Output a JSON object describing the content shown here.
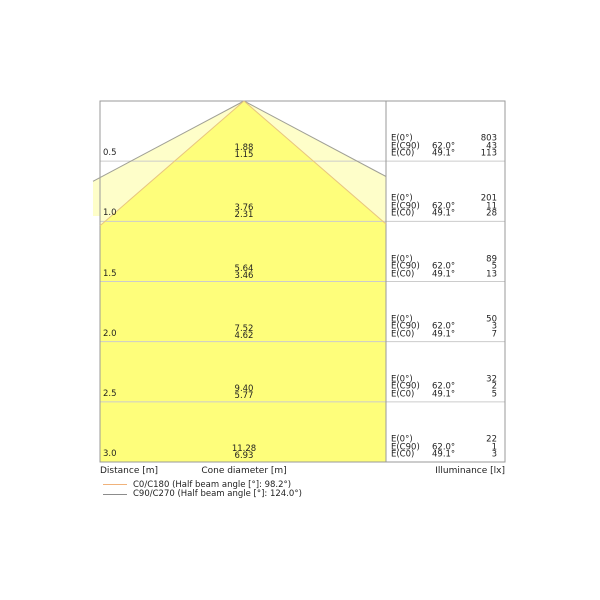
{
  "chart_data": {
    "type": "cone-diagram",
    "axes": {
      "distance_label": "Distance [m]",
      "cone_diameter_label": "Cone diameter [m]",
      "illuminance_label": "Illuminance [lx]"
    },
    "beams": {
      "c0_c180_half_beam_angle_deg": 98.2,
      "c90_c270_half_beam_angle_deg": 124.0,
      "c0_edge_angle_deg": 49.1,
      "c90_edge_angle_deg": 62.0
    },
    "e_row_labels": {
      "e0": "E(0°)",
      "ec90": "E(C90)",
      "ec0": "E(C0)"
    },
    "e_row_angles": {
      "e0": "",
      "ec90": "62.0°",
      "ec0": "49.1°"
    },
    "rows": [
      {
        "distance": "0.5",
        "cone_diameter_c90": "1.88",
        "cone_diameter_c0": "1.15",
        "e0": "803",
        "ec90": "43",
        "ec0": "113"
      },
      {
        "distance": "1.0",
        "cone_diameter_c90": "3.76",
        "cone_diameter_c0": "2.31",
        "e0": "201",
        "ec90": "11",
        "ec0": "28"
      },
      {
        "distance": "1.5",
        "cone_diameter_c90": "5.64",
        "cone_diameter_c0": "3.46",
        "e0": "89",
        "ec90": "5",
        "ec0": "13"
      },
      {
        "distance": "2.0",
        "cone_diameter_c90": "7.52",
        "cone_diameter_c0": "4.62",
        "e0": "50",
        "ec90": "3",
        "ec0": "7"
      },
      {
        "distance": "2.5",
        "cone_diameter_c90": "9.40",
        "cone_diameter_c0": "5.77",
        "e0": "32",
        "ec90": "2",
        "ec0": "5"
      },
      {
        "distance": "3.0",
        "cone_diameter_c90": "11.28",
        "cone_diameter_c0": "6.93",
        "e0": "22",
        "ec90": "1",
        "ec0": "3"
      }
    ],
    "legend": [
      {
        "label": "C0/C180 (Half beam angle [°]: 98.2°)",
        "color": "#f0b27a"
      },
      {
        "label": "C90/C270 (Half beam angle [°]: 124.0°)",
        "color": "#8c8c8c"
      }
    ],
    "colors": {
      "beam_inner_fill": "#fefe7b",
      "beam_outer_fill": "#fefec9",
      "beam_inner_stroke": "#e8c57f",
      "beam_outer_stroke": "#a0a096",
      "grid": "#cccccc",
      "border": "#999999",
      "text": "#1f1f1f",
      "background": "#ffffff"
    }
  }
}
